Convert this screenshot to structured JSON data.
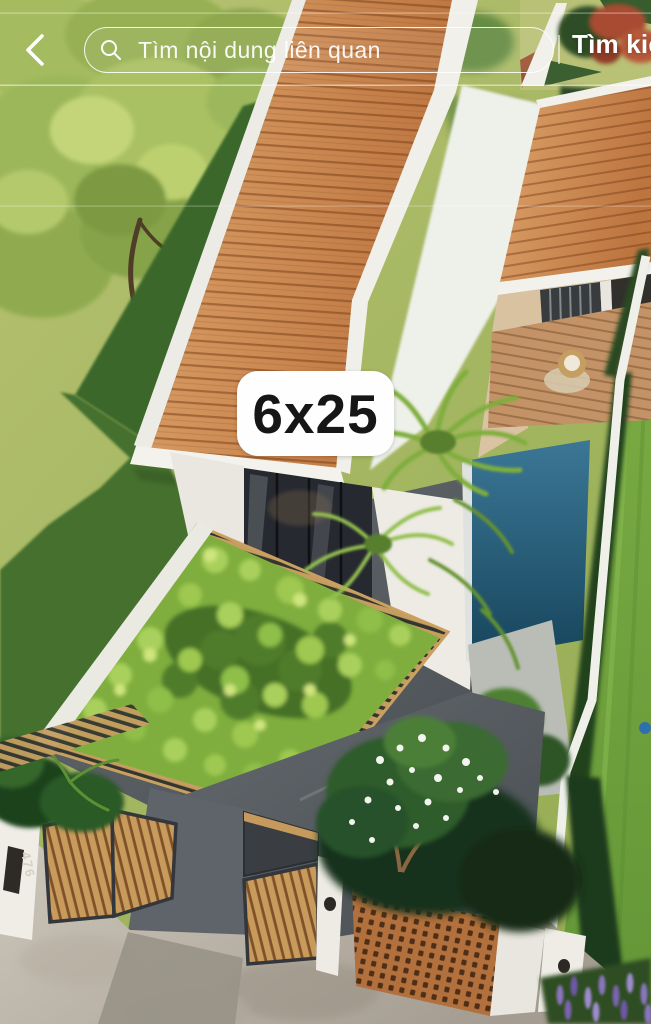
{
  "topbar": {
    "search_placeholder": "Tìm nội dung liên quan",
    "submit_label": "Tìm kiếm"
  },
  "badge": {
    "label": "6x25"
  },
  "scene": {
    "house_number": "476",
    "palette": {
      "roof_light": "#dca269",
      "roof_dark": "#bd7540",
      "lawn_light": "#aebc68",
      "lawn_shadow": "#3e692f",
      "lawn_bright": "#74a23e",
      "vine_green": "#7fae3e",
      "pool_blue": "#2c6584",
      "wall_white": "#efeee8",
      "wood_gate": "#c89a5c",
      "wood_lattice": "#b2703c",
      "glass_dark": "#26292f",
      "concrete_dark": "#565b60",
      "sidewalk": "#c0b9ad",
      "flower_red": "#a84b31",
      "lavender": "#8a74bd"
    }
  }
}
